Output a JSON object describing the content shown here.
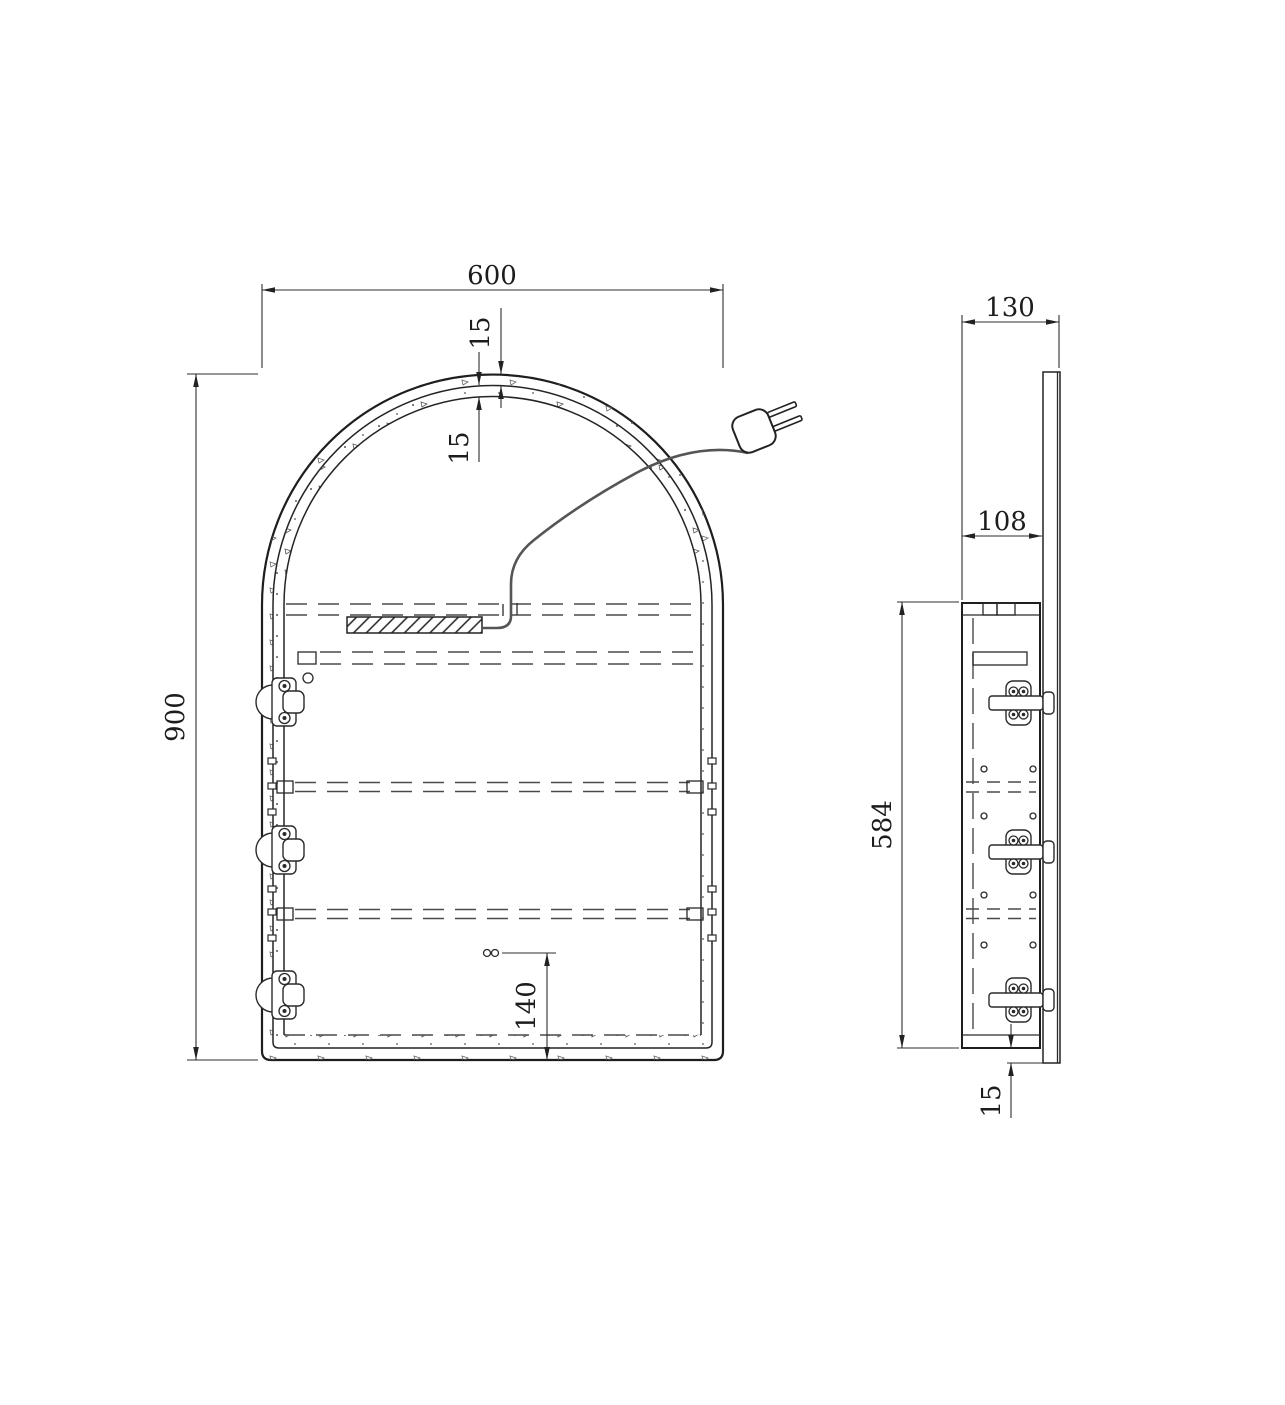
{
  "drawing": {
    "type": "technical-drawing",
    "subject": "arched-mirror-cabinet",
    "colors": {
      "line": "#222222",
      "dash": "#4a4a4a",
      "background": "#ffffff"
    },
    "components": {
      "power_plug": "two-prong-plug-icon",
      "power_cable": "power-cord",
      "led_driver": "hatched-driver-box",
      "hinge": "concealed-cabinet-hinge",
      "shelf": "dashed-shelf-line",
      "socket_holes": "twin-circle-holes"
    },
    "views": {
      "front": {
        "dimensions": {
          "width": "600",
          "frame_lip": "15",
          "frame_depth": "15",
          "height": "900",
          "socket_height": "140"
        }
      },
      "side": {
        "dimensions": {
          "total_depth": "130",
          "body_depth": "108",
          "body_height": "584",
          "door_overhang": "15"
        }
      }
    }
  }
}
